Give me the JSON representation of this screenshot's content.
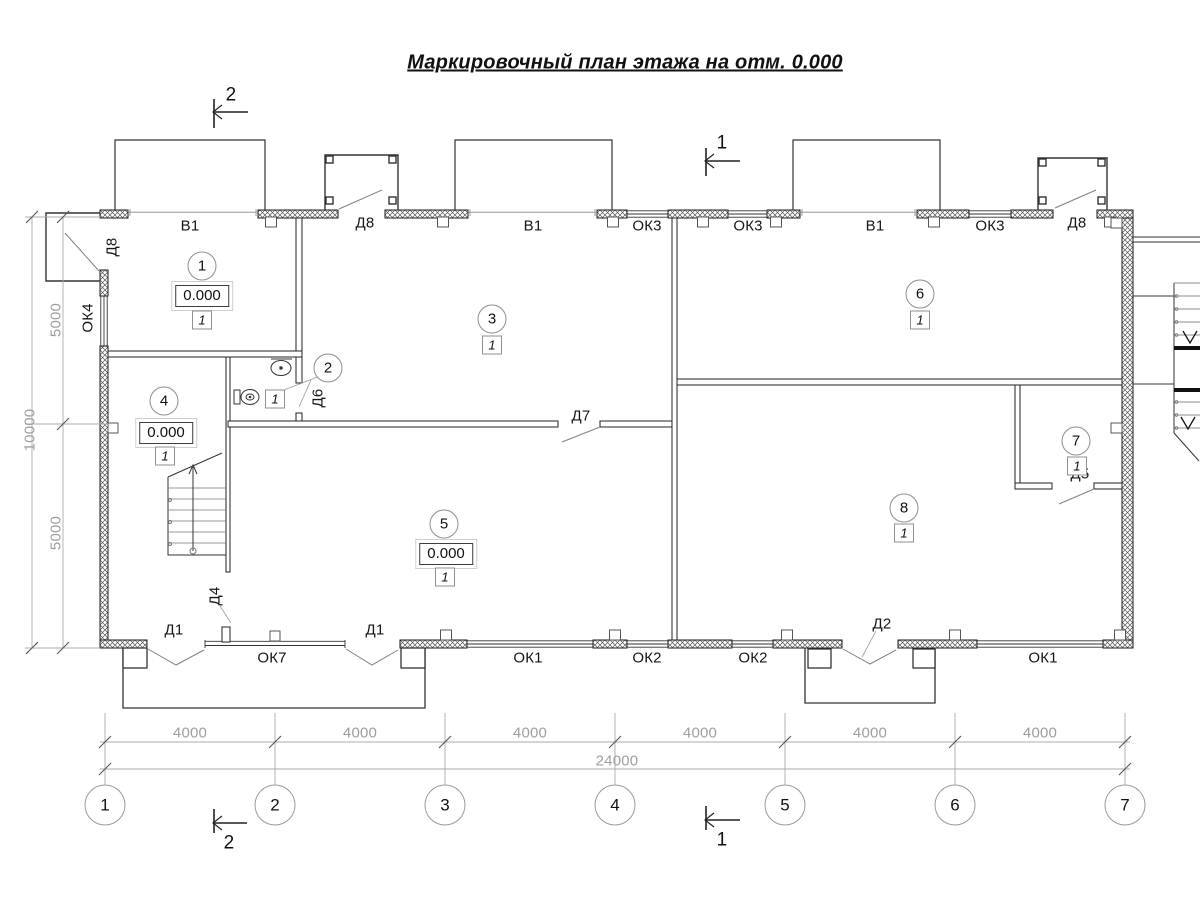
{
  "title": "Маркировочный план этажа на отм. 0.000",
  "sections": {
    "one": "1",
    "two": "2"
  },
  "openings": {
    "v1": "В1",
    "d1": "Д1",
    "d2": "Д2",
    "d4": "Д4",
    "d5": "Д5",
    "d6": "Д6",
    "d7": "Д7",
    "d8": "Д8",
    "ok1": "ОК1",
    "ok2": "ОК2",
    "ok3": "ОК3",
    "ok4": "ОК4",
    "ok7": "ОК7"
  },
  "rooms": [
    {
      "number": "1",
      "elevation": "0.000",
      "type_mark": "1"
    },
    {
      "number": "2",
      "type_mark": "1"
    },
    {
      "number": "3",
      "type_mark": "1"
    },
    {
      "number": "4",
      "elevation": "0.000",
      "type_mark": "1"
    },
    {
      "number": "5",
      "elevation": "0.000",
      "type_mark": "1"
    },
    {
      "number": "6",
      "type_mark": "1"
    },
    {
      "number": "7",
      "type_mark": "1"
    },
    {
      "number": "8",
      "type_mark": "1"
    }
  ],
  "axes": [
    "1",
    "2",
    "3",
    "4",
    "5",
    "6",
    "7"
  ],
  "dimensions": {
    "bay": "4000",
    "total": "24000",
    "left_upper": "5000",
    "left_total": "10000",
    "left_lower": "5000"
  },
  "colors": {
    "line": "#1a1a1a",
    "dim_text": "#9e9e9e",
    "hatch": "#555555"
  }
}
